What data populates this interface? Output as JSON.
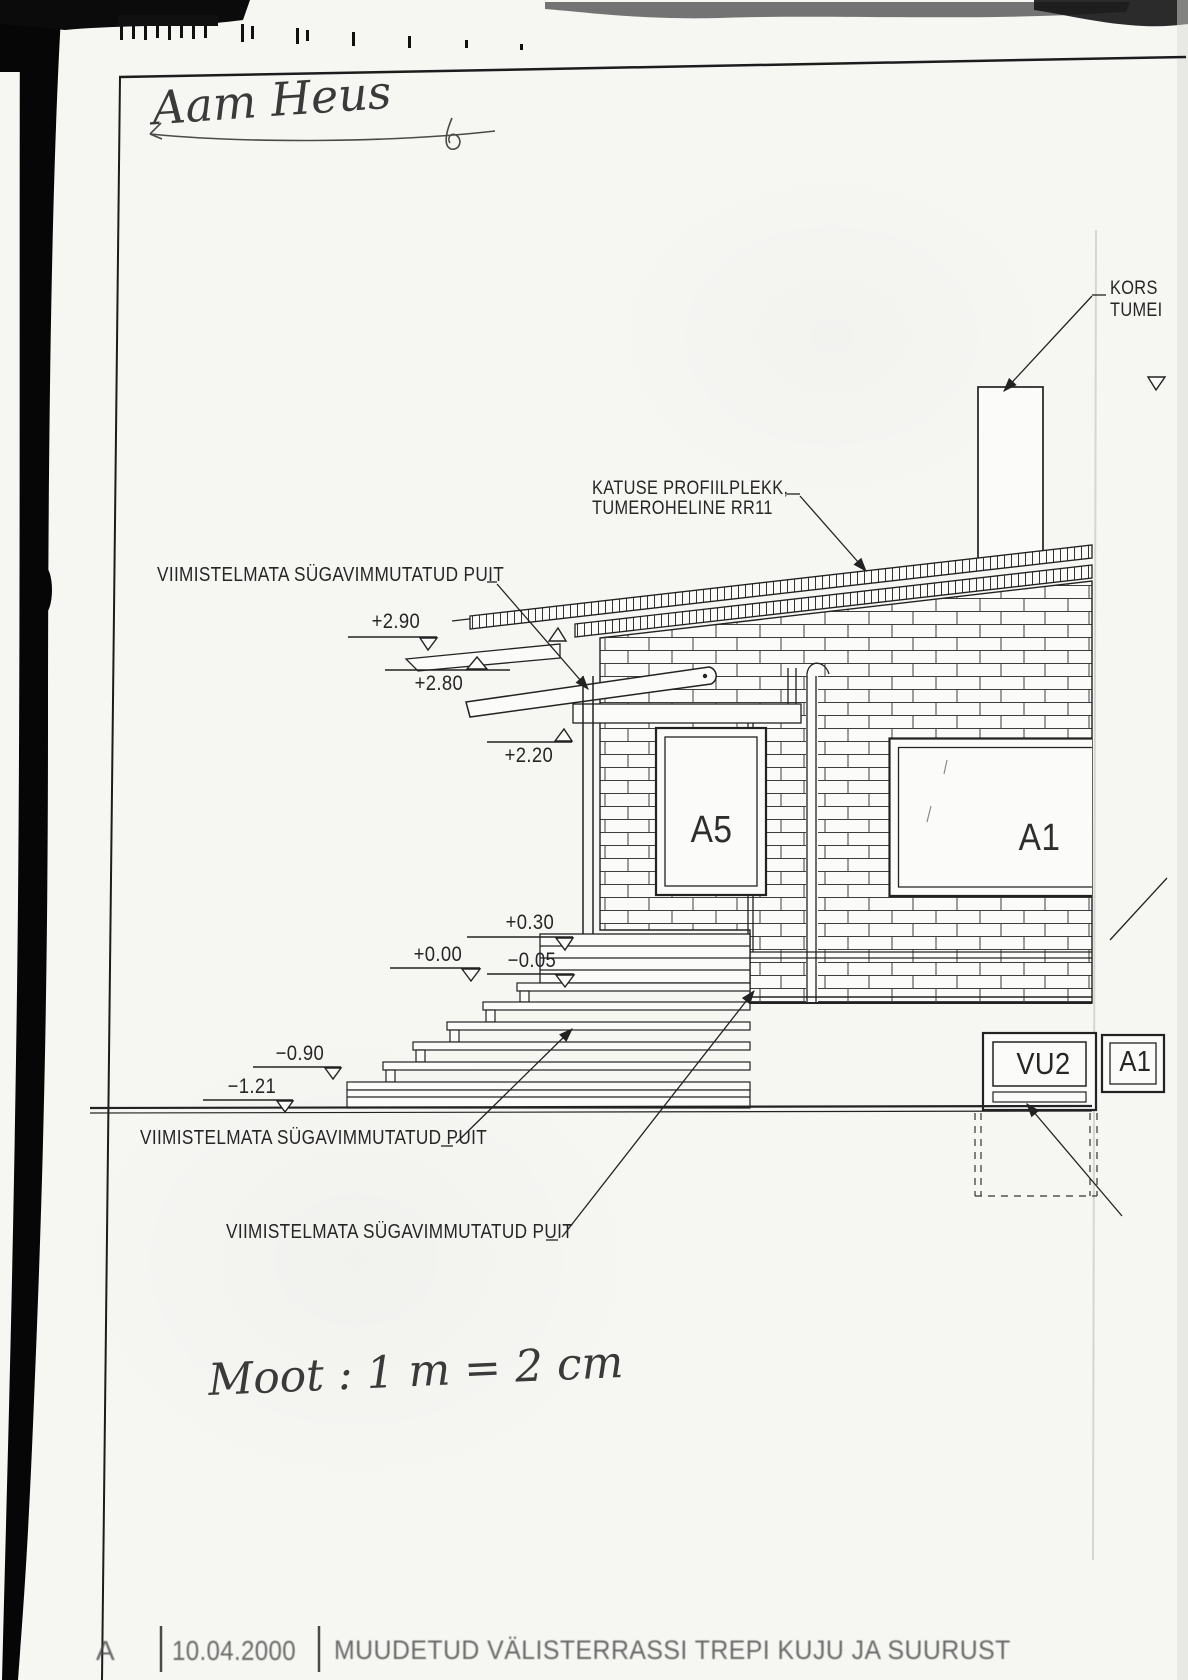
{
  "document": {
    "handwritten_signature": "Aam Heus",
    "handwritten_scale_note": "Moot :  1 m = 2 cm"
  },
  "annotations": {
    "wood_label_top": "VIIMISTELMATA SÜGAVIMMUTATUD PUIT",
    "wood_label_mid": "VIIMISTELMATA SÜGAVIMMUTATUD PUIT",
    "wood_label_bottom": "VIIMISTELMATA SÜGAVIMMUTATUD PUIT",
    "roof_label_line1": "KATUSE PROFIILPLEKK,",
    "roof_label_line2": "TUMEROHELINE RR11",
    "chimney_label_line1": "KORS",
    "chimney_label_line2": "TUMEI"
  },
  "levels": {
    "plus290": "+2.90",
    "plus280": "+2.80",
    "plus220": "+2.20",
    "plus030": "+0.30",
    "zero": "+0.00",
    "minus005": "−0.05",
    "minus090": "−0.90",
    "minus121": "−1.21"
  },
  "openings": {
    "window_a5": "A5",
    "window_a1": "A1",
    "vent_vu2": "VU2",
    "vent_a1": "A1"
  },
  "title_block": {
    "revision": "A",
    "date": "10.04.2000",
    "description": "MUUDETUD  VÄLISTERRASSI  TREPI  KUJU  JA  SUURUST"
  }
}
